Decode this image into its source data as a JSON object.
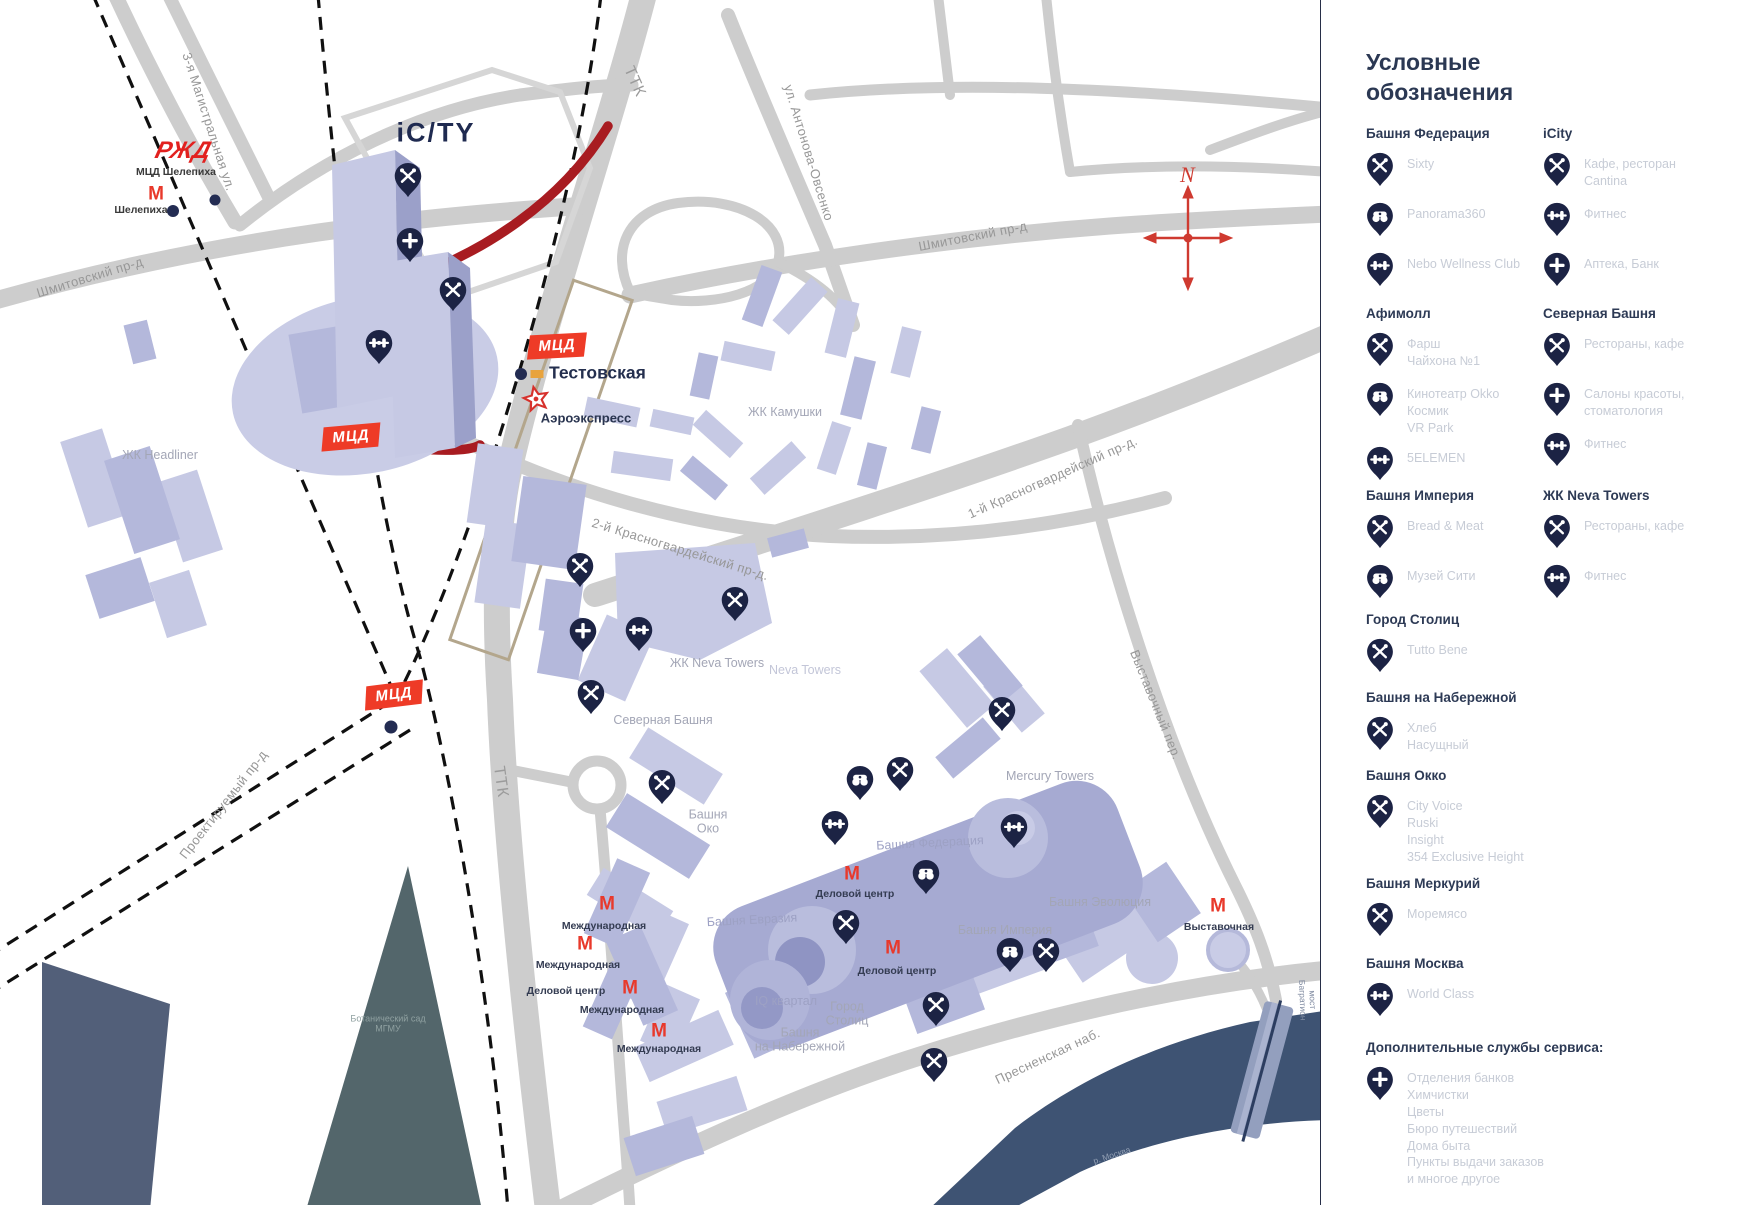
{
  "colors": {
    "pin_navy": "#1c2344",
    "accent_red": "#ee3b27",
    "metro_red": "#e8392b",
    "rail_red": "#a81c21",
    "river": "#3e5373",
    "park": "#53666b",
    "road": "#cdcdcd",
    "building_light": "#c6c9e4",
    "building_dark": "#a6aad2"
  },
  "legend": {
    "title": "Условные\nобозначения",
    "sections": [
      {
        "x": 45,
        "y": 126,
        "title": "Башня Федерация",
        "items": [
          {
            "icon": "restaurant-icon",
            "label": "Sixty"
          },
          {
            "icon": "binoculars-icon",
            "label": "Panorama360"
          },
          {
            "icon": "fitness-icon",
            "label": "Nebo Wellness Club"
          }
        ]
      },
      {
        "x": 222,
        "y": 126,
        "title": "iCity",
        "items": [
          {
            "icon": "restaurant-icon",
            "label": "Кафе, ресторан\nCantina"
          },
          {
            "icon": "fitness-icon",
            "label": "Фитнес"
          },
          {
            "icon": "plus-icon",
            "label": "Аптека, Банк"
          }
        ]
      },
      {
        "x": 45,
        "y": 306,
        "title": "Афимолл",
        "items": [
          {
            "icon": "restaurant-icon",
            "label": "Фарш\nЧайхона №1"
          },
          {
            "icon": "binoculars-icon",
            "label": "Кинотеатр Okko\nКосмик\nVR Park"
          },
          {
            "icon": "fitness-icon",
            "label": "5ELEMEN"
          }
        ]
      },
      {
        "x": 222,
        "y": 306,
        "title": "Северная Башня",
        "items": [
          {
            "icon": "restaurant-icon",
            "label": "Рестораны, кафе"
          },
          {
            "icon": "plus-icon",
            "label": "Салоны красоты,\nстоматология"
          },
          {
            "icon": "fitness-icon",
            "label": "Фитнес"
          }
        ]
      },
      {
        "x": 45,
        "y": 488,
        "title": "Башня Империя",
        "items": [
          {
            "icon": "restaurant-icon",
            "label": "Bread & Meat"
          },
          {
            "icon": "binoculars-icon",
            "label": "Музей Сити"
          }
        ]
      },
      {
        "x": 222,
        "y": 488,
        "title": "ЖК Neva Towers",
        "items": [
          {
            "icon": "restaurant-icon",
            "label": "Рестораны, кафе"
          },
          {
            "icon": "fitness-icon",
            "label": "Фитнес"
          }
        ]
      },
      {
        "x": 45,
        "y": 612,
        "title": "Город Столиц",
        "items": [
          {
            "icon": "restaurant-icon",
            "label": "Tutto Bene"
          }
        ]
      },
      {
        "x": 45,
        "y": 690,
        "title": "Башня на Набережной",
        "items": [
          {
            "icon": "restaurant-icon",
            "label": "Хлеб\nНасущный"
          }
        ]
      },
      {
        "x": 45,
        "y": 768,
        "title": "Башня Окко",
        "items": [
          {
            "icon": "restaurant-icon",
            "label": "City Voice\nRuski\nInsight\n354 Exclusive Height"
          }
        ]
      },
      {
        "x": 45,
        "y": 876,
        "title": "Башня Меркурий",
        "items": [
          {
            "icon": "restaurant-icon",
            "label": "Моремясо"
          }
        ]
      },
      {
        "x": 45,
        "y": 956,
        "title": "Башня Москва",
        "items": [
          {
            "icon": "fitness-icon",
            "label": "World Class"
          }
        ]
      },
      {
        "x": 45,
        "y": 1040,
        "title": "Дополнительные службы сервиса:",
        "items": [
          {
            "icon": "plus-icon",
            "label": "Отделения банков\nХимчистки\nЦветы\nБюро путешествий\nДома быта\nПункты выдачи заказов\nи многое другое"
          }
        ]
      }
    ]
  },
  "map": {
    "icity_logo": "iC/TY",
    "rzd_logo": "РЖД",
    "mcd_label": "МЦД",
    "compass_n": "N",
    "testovskaya": {
      "label": "Тестовская",
      "x": 549,
      "y": 373,
      "dot": [
        521,
        374
      ],
      "chip": [
        537,
        374
      ]
    },
    "aeroexpress": {
      "label": "Аэроэкспресс",
      "x": 586,
      "y": 418,
      "star": [
        536,
        399
      ]
    },
    "shelepikha": {
      "mcd_label": "МЦД Шелепиха",
      "mcd_x": 176,
      "mcd_y": 172,
      "metro_label": "Шелепиха",
      "lbl_x": 141,
      "lbl_y": 210,
      "m_x": 156,
      "m_y": 194,
      "rzd_x": 183,
      "rzd_y": 151
    },
    "mcd_badges": [
      {
        "x": 557,
        "y": 346,
        "r": -3
      },
      {
        "x": 351,
        "y": 437,
        "r": -5
      },
      {
        "x": 394,
        "y": 695,
        "r": -7
      }
    ],
    "navy_dots": [
      {
        "x": 521,
        "y": 374,
        "s": 12
      },
      {
        "x": 173,
        "y": 211,
        "s": 12
      },
      {
        "x": 215,
        "y": 200,
        "s": 11
      },
      {
        "x": 391,
        "y": 727,
        "s": 13
      }
    ],
    "metro": [
      {
        "mx": 607,
        "my": 904,
        "lx": 604,
        "ly": 926,
        "label": "Международная"
      },
      {
        "mx": 585,
        "my": 944,
        "lx": 578,
        "ly": 965,
        "label": "Международная"
      },
      {
        "mx": 630,
        "my": 988,
        "lx": 566,
        "ly": 991,
        "label": "Деловой центр"
      },
      {
        "mx": null,
        "my": null,
        "lx": 622,
        "ly": 1010,
        "label": "Международная"
      },
      {
        "mx": 659,
        "my": 1031,
        "lx": 659,
        "ly": 1049,
        "label": "Международная"
      },
      {
        "mx": 852,
        "my": 874,
        "lx": 855,
        "ly": 894,
        "label": "Деловой центр"
      },
      {
        "mx": 893,
        "my": 948,
        "lx": 897,
        "ly": 971,
        "label": "Деловой центр"
      },
      {
        "mx": 1218,
        "my": 906,
        "lx": 1219,
        "ly": 927,
        "label": "Выставочная"
      }
    ],
    "pins": [
      {
        "x": 408,
        "y": 183,
        "t": "restaurant-icon"
      },
      {
        "x": 410,
        "y": 248,
        "t": "plus-icon"
      },
      {
        "x": 453,
        "y": 297,
        "t": "restaurant-icon"
      },
      {
        "x": 379,
        "y": 350,
        "t": "fitness-icon"
      },
      {
        "x": 580,
        "y": 573,
        "t": "restaurant-icon"
      },
      {
        "x": 583,
        "y": 638,
        "t": "plus-icon"
      },
      {
        "x": 639,
        "y": 637,
        "t": "fitness-icon"
      },
      {
        "x": 735,
        "y": 607,
        "t": "restaurant-icon"
      },
      {
        "x": 591,
        "y": 700,
        "t": "restaurant-icon"
      },
      {
        "x": 662,
        "y": 790,
        "t": "restaurant-icon"
      },
      {
        "x": 1002,
        "y": 717,
        "t": "restaurant-icon"
      },
      {
        "x": 860,
        "y": 786,
        "t": "binoculars-icon"
      },
      {
        "x": 900,
        "y": 777,
        "t": "restaurant-icon"
      },
      {
        "x": 835,
        "y": 831,
        "t": "fitness-icon"
      },
      {
        "x": 1014,
        "y": 834,
        "t": "fitness-icon"
      },
      {
        "x": 926,
        "y": 880,
        "t": "binoculars-icon"
      },
      {
        "x": 846,
        "y": 930,
        "t": "restaurant-icon"
      },
      {
        "x": 1010,
        "y": 958,
        "t": "binoculars-icon"
      },
      {
        "x": 1046,
        "y": 958,
        "t": "restaurant-icon"
      },
      {
        "x": 936,
        "y": 1012,
        "t": "restaurant-icon"
      },
      {
        "x": 934,
        "y": 1068,
        "t": "restaurant-icon"
      }
    ],
    "labels": [
      {
        "t": "3-я Магистральная ул.",
        "x": 208,
        "y": 122,
        "r": 72,
        "c": "street"
      },
      {
        "t": "Шмитовский пр-д",
        "x": 90,
        "y": 278,
        "r": -17,
        "c": "street"
      },
      {
        "t": "ТТК",
        "x": 634,
        "y": 82,
        "r": 66,
        "c": "street-big"
      },
      {
        "t": "ул. Антонова-Овсенко",
        "x": 808,
        "y": 153,
        "r": 73,
        "c": "street"
      },
      {
        "t": "Шмитовский пр-д",
        "x": 973,
        "y": 237,
        "r": -11,
        "c": "street"
      },
      {
        "t": "2-й Красногвардейский пр-д.",
        "x": 680,
        "y": 550,
        "r": 17,
        "c": "street"
      },
      {
        "t": "1-й Красногвардейский пр-д.",
        "x": 1053,
        "y": 478,
        "r": -24,
        "c": "street"
      },
      {
        "t": "Выставочный пер.",
        "x": 1155,
        "y": 705,
        "r": 68,
        "c": "street"
      },
      {
        "t": "ТТК",
        "x": 500,
        "y": 782,
        "r": 82,
        "c": "street-big"
      },
      {
        "t": "Проектируемый пр-д",
        "x": 224,
        "y": 805,
        "r": -52,
        "c": "street"
      },
      {
        "t": "Пресненская наб.",
        "x": 1048,
        "y": 1057,
        "r": -25,
        "c": "street"
      },
      {
        "t": "мост Багратион",
        "x": 1307,
        "y": 1000,
        "r": 88,
        "c": "tiny"
      },
      {
        "t": "р. Москва",
        "x": 1112,
        "y": 1156,
        "r": -18,
        "c": "tiny2"
      },
      {
        "t": "ЖК Headliner",
        "x": 160,
        "y": 455,
        "r": 0,
        "c": "area"
      },
      {
        "t": "ЖК Камушки",
        "x": 785,
        "y": 412,
        "r": 0,
        "c": "area"
      },
      {
        "t": "ЖК Neva Towers",
        "x": 717,
        "y": 663,
        "r": 0,
        "c": "area"
      },
      {
        "t": "Neva Towers",
        "x": 805,
        "y": 670,
        "r": 0,
        "c": "area-faint"
      },
      {
        "t": "Северная Башня",
        "x": 663,
        "y": 720,
        "r": 0,
        "c": "area"
      },
      {
        "t": "Башня\nОко",
        "x": 708,
        "y": 822,
        "r": 0,
        "c": "area"
      },
      {
        "t": "Mercury Towers",
        "x": 1050,
        "y": 776,
        "r": 0,
        "c": "area"
      },
      {
        "t": "Башня Федерация",
        "x": 930,
        "y": 843,
        "r": -3,
        "c": "area-faint2"
      },
      {
        "t": "Башня Эволюция",
        "x": 1100,
        "y": 902,
        "r": 0,
        "c": "area"
      },
      {
        "t": "Башня Империя",
        "x": 1005,
        "y": 930,
        "r": 0,
        "c": "area"
      },
      {
        "t": "Башня Евразия",
        "x": 752,
        "y": 920,
        "r": -3,
        "c": "area-faint2"
      },
      {
        "t": "IQ квартал",
        "x": 786,
        "y": 1001,
        "r": 0,
        "c": "area-faint2"
      },
      {
        "t": "Город\nСтолиц",
        "x": 847,
        "y": 1014,
        "r": 0,
        "c": "area"
      },
      {
        "t": "Башня\nна Набережной",
        "x": 800,
        "y": 1040,
        "r": 0,
        "c": "area"
      },
      {
        "t": "Ботанический сад\nМГМУ",
        "x": 388,
        "y": 1024,
        "r": 0,
        "c": "park-label"
      }
    ]
  }
}
